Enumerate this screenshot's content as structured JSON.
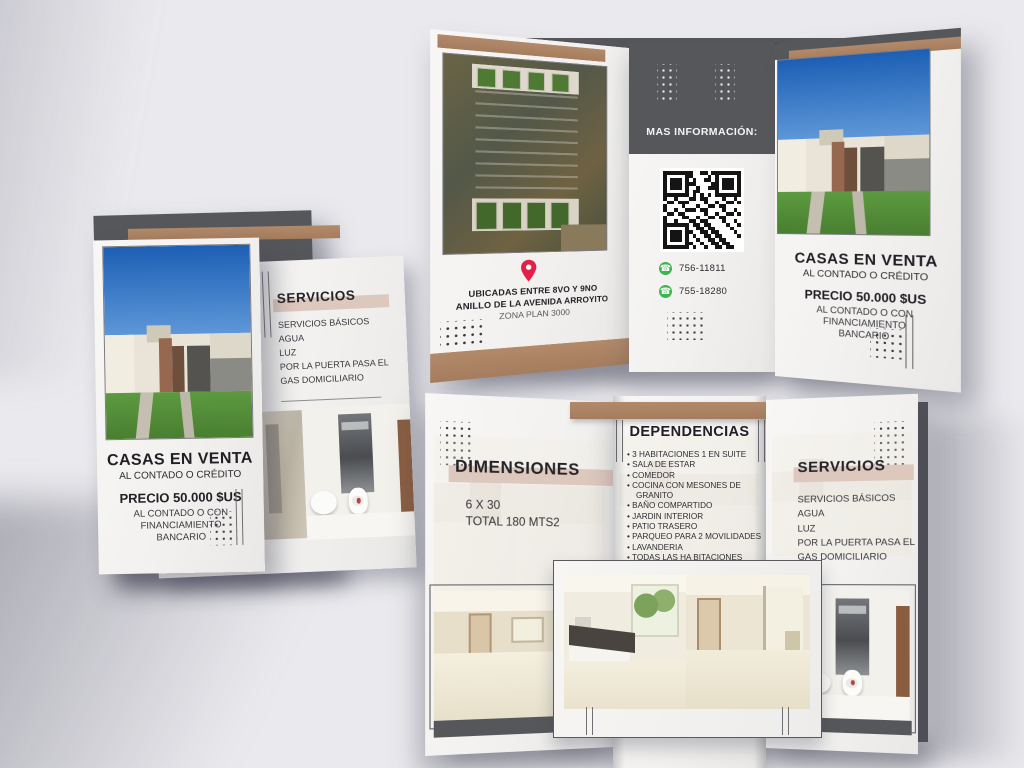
{
  "colors": {
    "background": "#eaeaee",
    "paper": "#f4f3f1",
    "dark_gray": "#56575b",
    "brown": "#ac8465",
    "beige_highlight": "#ddc8bd",
    "whatsapp_green": "#3db54e",
    "pin_red": "#e41e47"
  },
  "left_brochure": {
    "front": {
      "title": "CASAS EN VENTA",
      "subtitle": "AL CONTADO O CRÉDITO",
      "price": "PRECIO 50.000 $US",
      "price_note_lines": [
        "AL CONTADO O CON",
        "FINANCIAMIENTO",
        "BANCARIO"
      ]
    },
    "services": {
      "heading": "SERVICIOS",
      "lines": [
        "SERVICIOS BÁSICOS",
        "AGUA",
        "LUZ",
        "POR LA PUERTA PASA EL",
        "GAS DOMICILIARIO"
      ]
    }
  },
  "top_trifold": {
    "location_panel": {
      "lines": [
        "UBICADAS ENTRE 8VO Y 9NO",
        "ANILLO DE LA AVENIDA ARROYITO",
        "ZONA PLAN 3000"
      ]
    },
    "info_panel": {
      "heading": "MAS INFORMACIÓN:",
      "phones": [
        "756-11811",
        "755-18280"
      ]
    },
    "sale_panel": {
      "title": "CASAS EN VENTA",
      "subtitle": "AL CONTADO O CRÉDITO",
      "price": "PRECIO 50.000 $US",
      "price_note_lines": [
        "AL CONTADO O CON",
        "FINANCIAMIENTO",
        "BANCARIO"
      ]
    }
  },
  "bottom_trifold": {
    "dimensions_panel": {
      "heading": "DIMENSIONES",
      "lines": [
        "6 X 30",
        "TOTAL 180 MTS2"
      ]
    },
    "dependencias_panel": {
      "heading": "DEPENDENCIAS",
      "items": [
        "3 HABITACIONES 1 EN SUITE",
        "SALA DE ESTAR",
        "COMEDOR",
        "COCINA CON MESONES DE GRANITO",
        "BAÑO COMPARTIDO",
        "JARDIN INTERIOR",
        "PATIO TRASERO",
        "PARQUEO PARA 2 MOVILIDADES",
        "LAVANDERIA",
        "TODAS LAS HA BITACIONES TIENEN PUNTOS PARA AC Y TV CABLE",
        "122 MTS CONSTRUIDOS"
      ]
    },
    "services_panel": {
      "heading": "SERVICIOS",
      "lines": [
        "SERVICIOS BÁSICOS",
        "AGUA",
        "LUZ",
        "POR LA PUERTA PASA EL",
        "GAS DOMICILIARIO"
      ]
    }
  }
}
